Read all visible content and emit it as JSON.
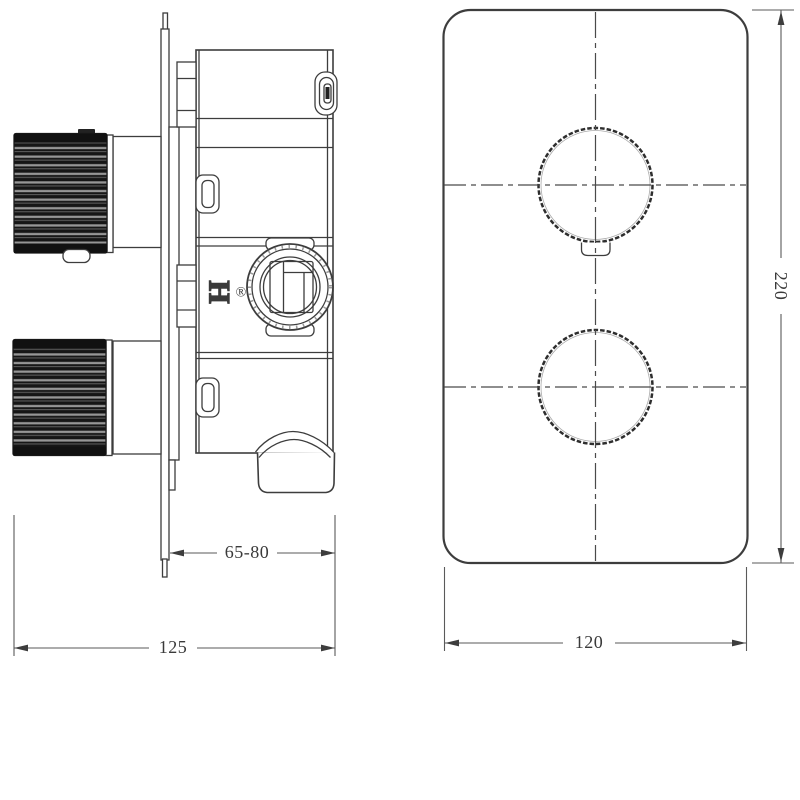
{
  "colors": {
    "background": "#ffffff",
    "line": "#3d3d3d",
    "dimension_line": "#5a5a5a",
    "text": "#3a3a3a",
    "knob_dark": "#161616",
    "knob_stripe": "#969696"
  },
  "side_view": {
    "logo": "H",
    "registered_mark": "®",
    "dimensions": {
      "depth_range": "65-80",
      "overall_depth": "125"
    }
  },
  "front_view": {
    "dimensions": {
      "plate_width": "120",
      "plate_height": "220"
    }
  }
}
